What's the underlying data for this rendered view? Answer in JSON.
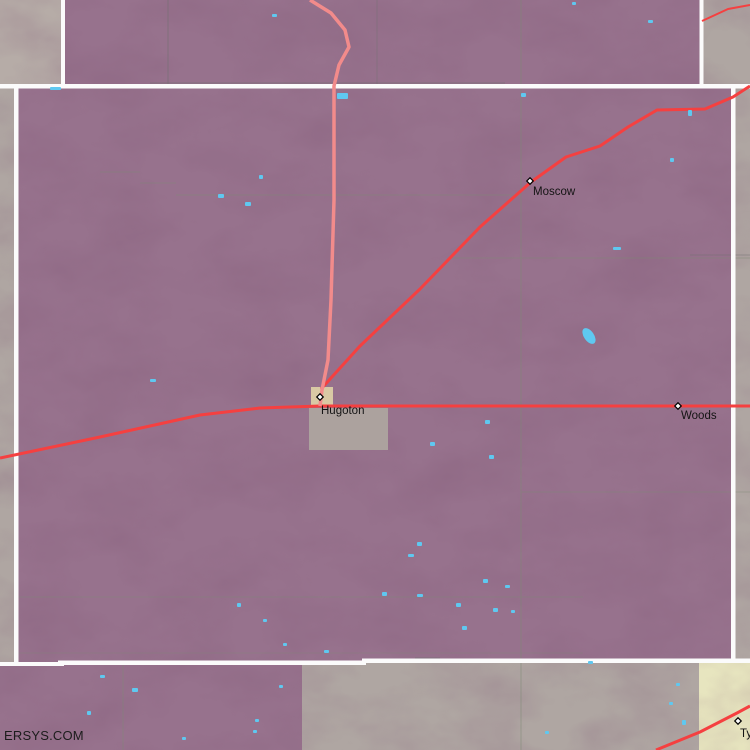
{
  "page": {
    "watermark": "ERSYS.COM"
  },
  "map": {
    "width": 750,
    "height": 750,
    "colors": {
      "county": "#97728D",
      "gray": "#AFA6A2",
      "gray_light": "#B6ACA7",
      "yellow": "#E7E5BF",
      "boundary_white": "#FBFBFB",
      "road_primary": "#F54040",
      "road_secondary": "#F28B8B",
      "lake": "#5FC8F0",
      "grid": "#7D8B74",
      "dark": "#6F6F6F",
      "city_tan": "#D9C9A4",
      "urban_gray": "#ACA29E",
      "label": "#141414"
    },
    "regions": [
      {
        "name": "county-interior-base",
        "x": 0,
        "y": 0,
        "w": 750,
        "h": 750,
        "fill": "county"
      },
      {
        "name": "neighbor-county-top-left",
        "x": 0,
        "y": 0,
        "w": 63,
        "h": 86,
        "fill": "gray_light"
      },
      {
        "name": "neighbor-county-top-right",
        "x": 700,
        "y": 0,
        "w": 50,
        "h": 86,
        "fill": "gray"
      },
      {
        "name": "neighbor-county-west",
        "x": 0,
        "y": 86,
        "w": 14,
        "h": 578,
        "fill": "gray"
      },
      {
        "name": "neighbor-county-east",
        "x": 733,
        "y": 85,
        "w": 17,
        "h": 578,
        "fill": "gray"
      },
      {
        "name": "neighbor-county-south",
        "x": 302,
        "y": 662,
        "w": 397,
        "h": 88,
        "fill": "gray"
      },
      {
        "name": "neighbor-county-south-east",
        "x": 699,
        "y": 662,
        "w": 51,
        "h": 88,
        "fill": "yellow"
      }
    ],
    "urban_areas": [
      {
        "name": "hugoton-urban-area",
        "x": 309,
        "y": 408,
        "w": 79,
        "h": 42,
        "fill": "urban_gray"
      },
      {
        "name": "hugoton-city-block",
        "x": 311,
        "y": 387,
        "w": 22,
        "h": 19,
        "fill": "city_tan"
      }
    ],
    "grid_lines": [
      {
        "x1": 521,
        "y1": 0,
        "x2": 521,
        "y2": 750,
        "c": "grid",
        "o": 0.5
      },
      {
        "x1": 168,
        "y1": 0,
        "x2": 168,
        "y2": 86,
        "c": "dark",
        "o": 0.55
      },
      {
        "x1": 377,
        "y1": 0,
        "x2": 377,
        "y2": 86,
        "c": "dark",
        "o": 0.4
      },
      {
        "x1": 123,
        "y1": 664,
        "x2": 123,
        "y2": 750,
        "c": "grid",
        "o": 0.45
      },
      {
        "x1": 100,
        "y1": 172,
        "x2": 140,
        "y2": 172,
        "c": "grid",
        "o": 0.4
      },
      {
        "x1": 140,
        "y1": 183,
        "x2": 176,
        "y2": 183,
        "c": "grid",
        "o": 0.4
      },
      {
        "x1": 176,
        "y1": 195,
        "x2": 521,
        "y2": 195,
        "c": "grid",
        "o": 0.45
      },
      {
        "x1": 450,
        "y1": 258,
        "x2": 750,
        "y2": 258,
        "c": "grid",
        "o": 0.45
      },
      {
        "x1": 521,
        "y1": 492,
        "x2": 750,
        "y2": 492,
        "c": "grid",
        "o": 0.4
      },
      {
        "x1": 15,
        "y1": 597,
        "x2": 583,
        "y2": 597,
        "c": "grid",
        "o": 0.4
      },
      {
        "x1": 15,
        "y1": 653,
        "x2": 583,
        "y2": 653,
        "c": "grid",
        "o": 0.3
      },
      {
        "x1": 150,
        "y1": 83,
        "x2": 505,
        "y2": 83,
        "c": "dark",
        "o": 0.5
      },
      {
        "x1": 415,
        "y1": 658,
        "x2": 440,
        "y2": 658,
        "c": "dark",
        "o": 0.5
      },
      {
        "x1": 690,
        "y1": 255,
        "x2": 750,
        "y2": 255,
        "c": "dark",
        "o": 0.45
      }
    ],
    "boundaries": [
      {
        "x": 0,
        "y": 84,
        "w": 750,
        "h": 4.5
      },
      {
        "x": 61,
        "y": 0,
        "w": 4,
        "h": 86
      },
      {
        "x": 699.5,
        "y": 0,
        "w": 4,
        "h": 86
      },
      {
        "x": 14,
        "y": 86,
        "w": 4.5,
        "h": 578
      },
      {
        "x": 731,
        "y": 85,
        "w": 4.5,
        "h": 576
      },
      {
        "x": 0,
        "y": 662,
        "w": 64,
        "h": 4
      },
      {
        "x": 58,
        "y": 660.5,
        "w": 308,
        "h": 4.5
      },
      {
        "x": 362,
        "y": 658.5,
        "w": 388,
        "h": 4.5
      }
    ],
    "roads": [
      {
        "kind": "primary",
        "w": 3,
        "points": [
          [
            0,
            458
          ],
          [
            100,
            437
          ],
          [
            200,
            415
          ],
          [
            260,
            408
          ],
          [
            320,
            406
          ],
          [
            750,
            406
          ]
        ]
      },
      {
        "kind": "primary",
        "w": 3,
        "points": [
          [
            321,
            389
          ],
          [
            360,
            346
          ],
          [
            420,
            289
          ],
          [
            480,
            227
          ],
          [
            531,
            182
          ],
          [
            566,
            157
          ],
          [
            600,
            146
          ],
          [
            628,
            127
          ],
          [
            657,
            110
          ],
          [
            705,
            109
          ],
          [
            733,
            97
          ],
          [
            750,
            86
          ]
        ]
      },
      {
        "kind": "primary",
        "w": 3,
        "points": [
          [
            656,
            750
          ],
          [
            700,
            732
          ],
          [
            737,
            713
          ],
          [
            750,
            706
          ]
        ]
      },
      {
        "kind": "primary",
        "w": 2,
        "points": [
          [
            702,
            21
          ],
          [
            728,
            9
          ],
          [
            750,
            5
          ]
        ]
      },
      {
        "kind": "secondary",
        "w": 3.5,
        "points": [
          [
            310,
            0
          ],
          [
            331,
            13
          ],
          [
            345,
            30
          ],
          [
            349,
            47
          ],
          [
            339,
            65
          ],
          [
            334,
            86
          ],
          [
            334,
            200
          ],
          [
            331,
            300
          ],
          [
            328,
            360
          ],
          [
            322,
            390
          ],
          [
            320,
            406
          ]
        ]
      }
    ],
    "lakes": [
      [
        272,
        14,
        5,
        3
      ],
      [
        572,
        2,
        4,
        3
      ],
      [
        648,
        20,
        5,
        3
      ],
      [
        521,
        93,
        5,
        4
      ],
      [
        337,
        93,
        11,
        6
      ],
      [
        50,
        87,
        11,
        3
      ],
      [
        218,
        194,
        6,
        4
      ],
      [
        259,
        175,
        4,
        4
      ],
      [
        245,
        202,
        6,
        4
      ],
      [
        150,
        379,
        6,
        3
      ],
      [
        613,
        247,
        8,
        3
      ],
      [
        670,
        158,
        4,
        4
      ],
      [
        688,
        110,
        4,
        6
      ],
      [
        485,
        420,
        5,
        4
      ],
      [
        430,
        442,
        5,
        4
      ],
      [
        489,
        455,
        5,
        4
      ],
      [
        417,
        542,
        5,
        4
      ],
      [
        408,
        554,
        6,
        3
      ],
      [
        483,
        579,
        5,
        4
      ],
      [
        505,
        585,
        5,
        3
      ],
      [
        382,
        592,
        5,
        4
      ],
      [
        417,
        594,
        6,
        3
      ],
      [
        456,
        603,
        5,
        4
      ],
      [
        493,
        608,
        5,
        4
      ],
      [
        511,
        610,
        4,
        3
      ],
      [
        462,
        626,
        5,
        4
      ],
      [
        237,
        603,
        4,
        4
      ],
      [
        263,
        619,
        4,
        3
      ],
      [
        100,
        675,
        5,
        3
      ],
      [
        132,
        688,
        6,
        4
      ],
      [
        87,
        711,
        4,
        4
      ],
      [
        182,
        737,
        4,
        3
      ],
      [
        255,
        719,
        4,
        3
      ],
      [
        253,
        730,
        4,
        3
      ],
      [
        279,
        685,
        4,
        3
      ],
      [
        283,
        643,
        4,
        3
      ],
      [
        324,
        650,
        5,
        3
      ],
      [
        588,
        661,
        5,
        3
      ],
      [
        676,
        683,
        4,
        3
      ],
      [
        669,
        702,
        4,
        3
      ],
      [
        682,
        720,
        4,
        5
      ],
      [
        545,
        731,
        4,
        3
      ]
    ],
    "big_lake": {
      "cx": 589,
      "cy": 336,
      "rx": 5,
      "ry": 9,
      "rot": -35
    },
    "towns": [
      {
        "name": "Moscow",
        "marker": [
          530,
          181
        ],
        "label": [
          533,
          195
        ]
      },
      {
        "name": "Hugoton",
        "marker": [
          320,
          397
        ],
        "label": [
          321,
          414
        ]
      },
      {
        "name": "Woods",
        "marker": [
          678,
          406
        ],
        "label": [
          681,
          419
        ]
      },
      {
        "name": "Ty",
        "marker": [
          738,
          721
        ],
        "label": [
          740,
          737
        ]
      }
    ]
  }
}
